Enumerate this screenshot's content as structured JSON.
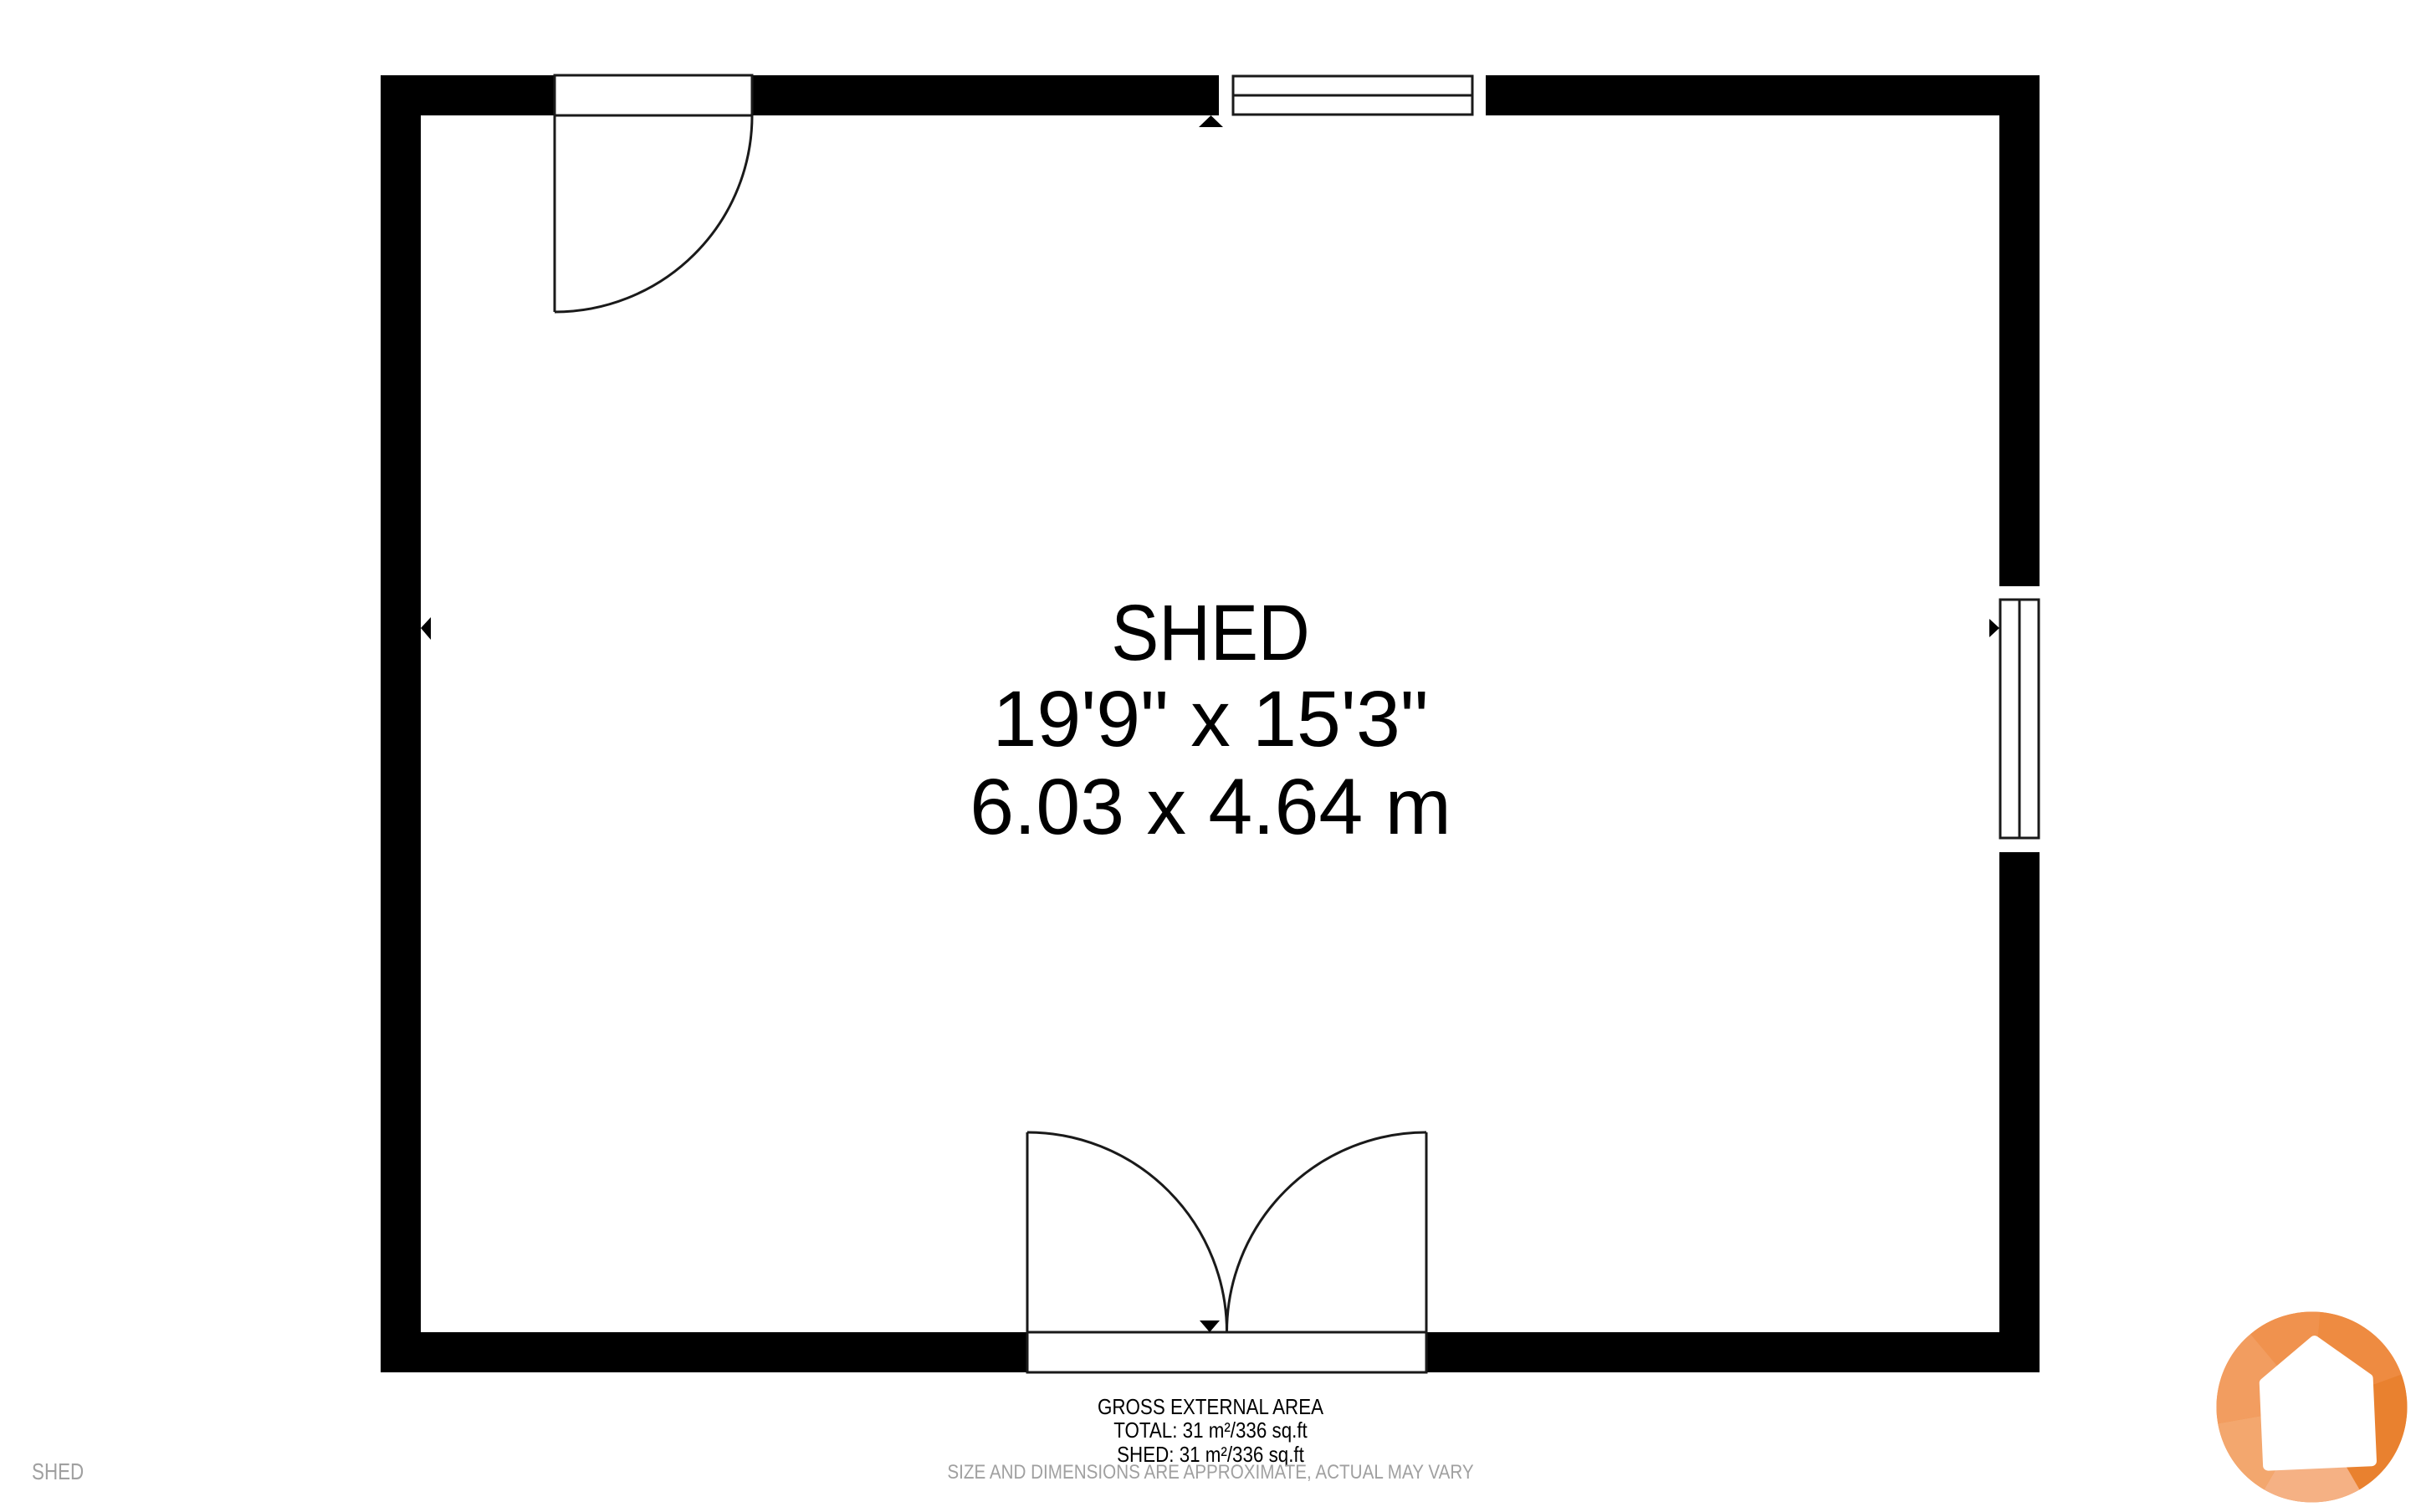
{
  "room": {
    "name": "SHED",
    "dims_imperial": "19'9\" x 15'3\"",
    "dims_metric": "6.03 x 4.64 m"
  },
  "footer": {
    "title": "GROSS EXTERNAL AREA",
    "total": "TOTAL: 31 m²/336 sq.ft",
    "shed": "SHED: 31 m²/336 sq.ft",
    "disclaimer": "SIZE AND DIMENSIONS ARE APPROXIMATE, ACTUAL MAY VARY"
  },
  "watermark": "SHED",
  "colors": {
    "wall": "#000000",
    "text": "#000000",
    "muted": "#A0A0A0",
    "line": "#1a1a1a",
    "logo_base": "#EF8E45",
    "logo_house": "#ffffff"
  },
  "logo": {
    "facets": [
      "#EE8B41",
      "#E9812F",
      "#F5B184",
      "#F3A76E",
      "#F29D60",
      "#F0924E"
    ]
  }
}
